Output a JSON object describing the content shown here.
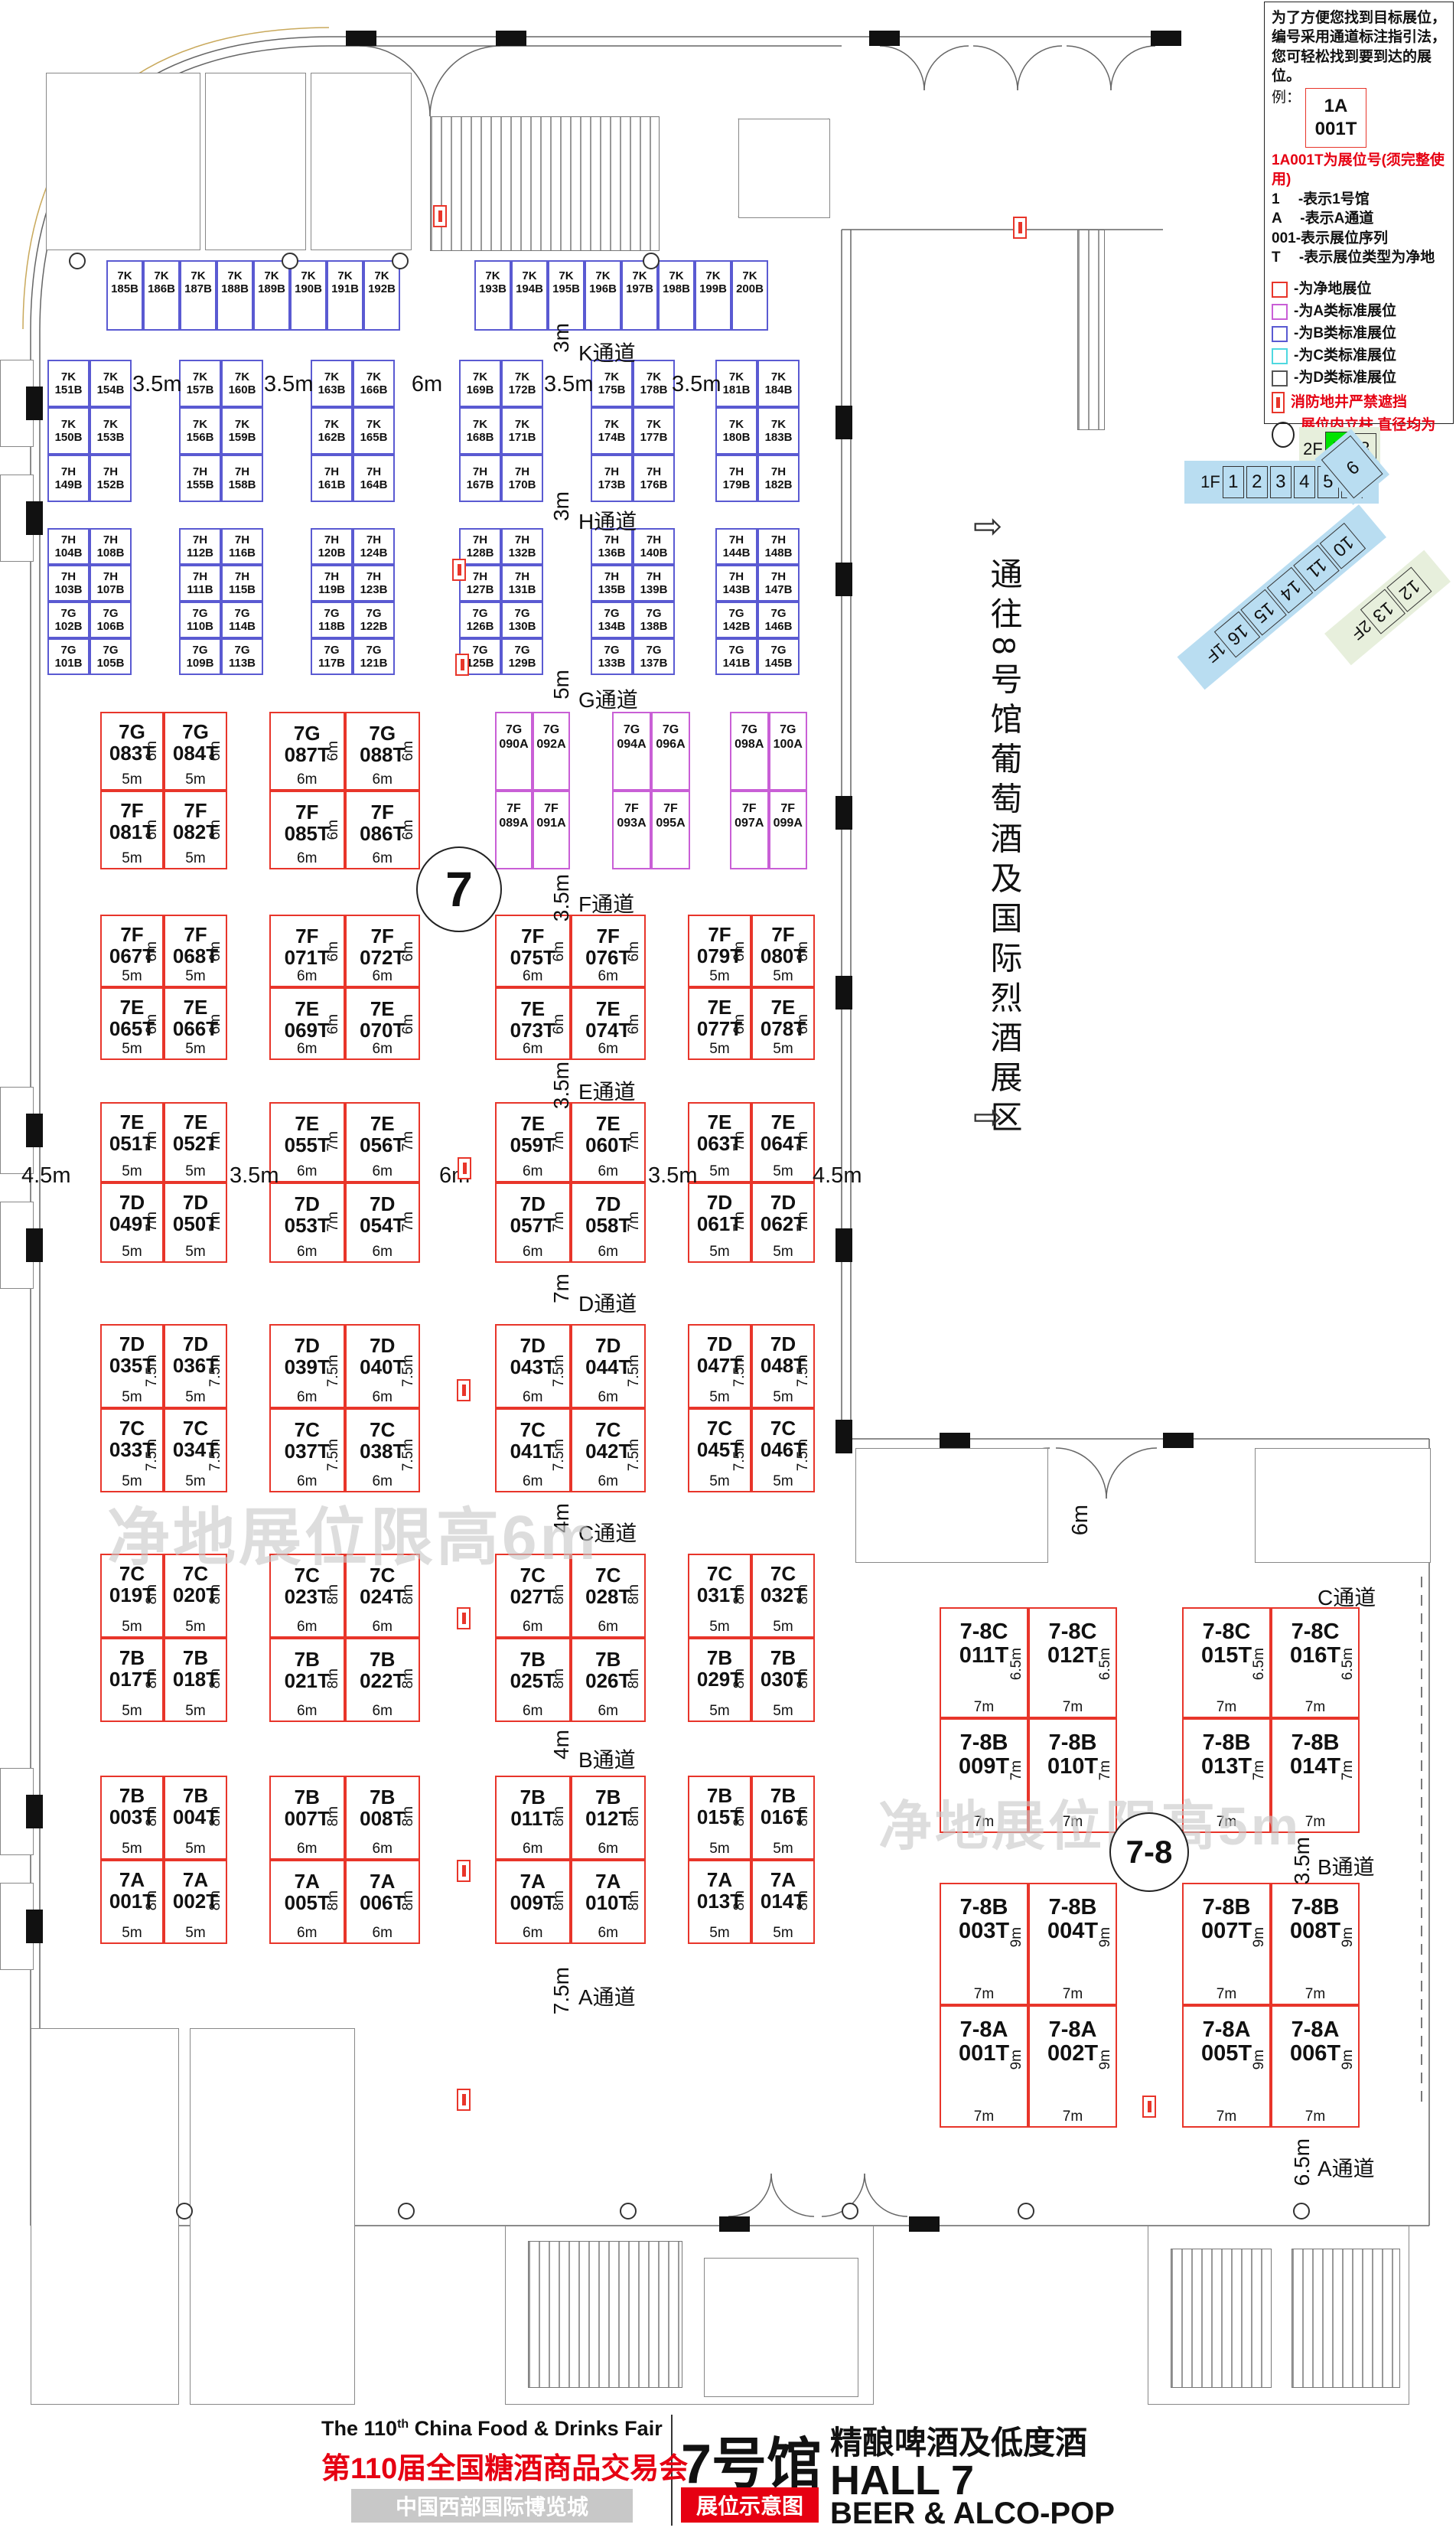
{
  "colors": {
    "net_red": "#e8352a",
    "class_a": "#c95fd6",
    "class_b": "#5a5ad2",
    "class_c": "#4fd8e0",
    "class_d": "#555555",
    "highlight_green": "#00e300",
    "nav_blue": "#b9ddf1",
    "nav_green_bg": "#e7efdc",
    "accent_red": "#e60012",
    "watermark_gray": "#c9c9c9"
  },
  "legend": {
    "intro": "为了方便您找到目标展位，编号采用通道标注指引法，您可轻松找到要到达的展位。",
    "example_label": "例：",
    "example_line1": "1A",
    "example_line2": "001T",
    "example_note": "1A001T为展位号(须完整使用)",
    "explain_lines": [
      "1　 -表示1号馆",
      "A　 -表示A通道",
      "001-表示展位序列",
      "T　 -表示展位类型为净地"
    ],
    "key_items": [
      {
        "name": "net",
        "color": "#e8352a",
        "text": "-为净地展位"
      },
      {
        "name": "class-a",
        "color": "#c95fd6",
        "text": "-为A类标准展位"
      },
      {
        "name": "class-b",
        "color": "#5a5ad2",
        "text": "-为B类标准展位"
      },
      {
        "name": "class-c",
        "color": "#4fd8e0",
        "text": "-为C类标准展位"
      },
      {
        "name": "class-d",
        "color": "#555555",
        "text": "-为D类标准展位"
      }
    ],
    "fire_note": "消防地井严禁遮挡",
    "pillar_note": "展位内立柱 直径均为1.5m"
  },
  "floor_nav": {
    "upper": [
      "2F",
      "7",
      "8"
    ],
    "lower": [
      "1F",
      "1",
      "2",
      "3",
      "4",
      "5",
      "6"
    ],
    "bend": "9",
    "diagonal": [
      "10",
      "11",
      "14",
      "15",
      "16",
      "1F"
    ],
    "green_diagonal": [
      "12",
      "13",
      "2F"
    ]
  },
  "corridor_note": {
    "arrow": "⇨",
    "text": "通往8号馆葡萄酒及国际烈酒展区"
  },
  "watermark_main": "净地展位限高6m",
  "watermark_annex": "净地展位限高5m",
  "hall_circle": "7",
  "annex_circle": "7-8",
  "door_width_note": "6m",
  "aisles_main": [
    {
      "dim": "3m",
      "label": "K通道"
    },
    {
      "dim": "3m",
      "label": "H通道"
    },
    {
      "dim": "5m",
      "label": "G通道"
    },
    {
      "dim": "3.5m",
      "label": "F通道"
    },
    {
      "dim": "3.5m",
      "label": "E通道"
    },
    {
      "dim": "7m",
      "label": "D通道"
    },
    {
      "dim": "4m",
      "label": "C通道"
    },
    {
      "dim": "4m",
      "label": "B通道"
    },
    {
      "dim": "7.5m",
      "label": "A通道"
    }
  ],
  "aisles_annex": [
    {
      "dim": "",
      "label": "C通道"
    },
    {
      "dim": "3.5m",
      "label": "B通道"
    },
    {
      "dim": "6.5m",
      "label": "A通道"
    }
  ],
  "k_gap_labels": [
    "3.5m",
    "3.5m",
    "6m",
    "3.5m",
    "3.5m"
  ],
  "ed_mid_labels": [
    "4.5m",
    "3.5m",
    "6m",
    "3.5m",
    "4.5m"
  ],
  "k_top_row": {
    "group1": [
      "7K 185B",
      "7K 186B",
      "7K 187B",
      "7K 188B",
      "7K 189B",
      "7K 190B",
      "7K 191B",
      "7K 192B"
    ],
    "group2": [
      "7K 193B",
      "7K 194B",
      "7K 195B",
      "7K 196B",
      "7K 197B",
      "7K 198B",
      "7K 199B",
      "7K 200B"
    ]
  },
  "k_blocks": [
    [
      [
        "7K 151B",
        "7K 154B"
      ],
      [
        "7K 150B",
        "7K 153B"
      ],
      [
        "7H 149B",
        "7H 152B"
      ]
    ],
    [
      [
        "7K 157B",
        "7K 160B"
      ],
      [
        "7K 156B",
        "7K 159B"
      ],
      [
        "7H 155B",
        "7H 158B"
      ]
    ],
    [
      [
        "7K 163B",
        "7K 166B"
      ],
      [
        "7K 162B",
        "7K 165B"
      ],
      [
        "7H 161B",
        "7H 164B"
      ]
    ],
    [
      [
        "7K 169B",
        "7K 172B"
      ],
      [
        "7K 168B",
        "7K 171B"
      ],
      [
        "7H 167B",
        "7H 170B"
      ]
    ],
    [
      [
        "7K 175B",
        "7K 178B"
      ],
      [
        "7K 174B",
        "7K 177B"
      ],
      [
        "7H 173B",
        "7H 176B"
      ]
    ],
    [
      [
        "7K 181B",
        "7K 184B"
      ],
      [
        "7K 180B",
        "7K 183B"
      ],
      [
        "7H 179B",
        "7H 182B"
      ]
    ]
  ],
  "h_blocks": [
    [
      [
        "7H 104B",
        "7H 108B"
      ],
      [
        "7H 103B",
        "7H 107B"
      ],
      [
        "7G 102B",
        "7G 106B"
      ],
      [
        "7G 101B",
        "7G 105B"
      ]
    ],
    [
      [
        "7H 112B",
        "7H 116B"
      ],
      [
        "7H 111B",
        "7H 115B"
      ],
      [
        "7G 110B",
        "7G 114B"
      ],
      [
        "7G 109B",
        "7G 113B"
      ]
    ],
    [
      [
        "7H 120B",
        "7H 124B"
      ],
      [
        "7H 119B",
        "7H 123B"
      ],
      [
        "7G 118B",
        "7G 122B"
      ],
      [
        "7G 117B",
        "7G 121B"
      ]
    ],
    [
      [
        "7H 128B",
        "7H 132B"
      ],
      [
        "7H 127B",
        "7H 131B"
      ],
      [
        "7G 126B",
        "7G 130B"
      ],
      [
        "7G 125B",
        "7G 129B"
      ]
    ],
    [
      [
        "7H 136B",
        "7H 140B"
      ],
      [
        "7H 135B",
        "7H 139B"
      ],
      [
        "7G 134B",
        "7G 138B"
      ],
      [
        "7G 133B",
        "7G 137B"
      ]
    ],
    [
      [
        "7H 144B",
        "7H 148B"
      ],
      [
        "7H 143B",
        "7H 147B"
      ],
      [
        "7G 142B",
        "7G 146B"
      ],
      [
        "7G 141B",
        "7G 145B"
      ]
    ]
  ],
  "t_sections": [
    {
      "name": "G-F",
      "blocks": [
        {
          "type": "red",
          "rows": [
            [
              "7G 083T",
              "7G 084T"
            ],
            [
              "7F 081T",
              "7F 082T"
            ]
          ],
          "row_dims": [
            "6m",
            "6m"
          ],
          "col_dims": [
            "5m",
            "5m"
          ]
        },
        {
          "type": "red",
          "rows": [
            [
              "7G 087T",
              "7G 088T"
            ],
            [
              "7F 085T",
              "7F 086T"
            ]
          ],
          "row_dims": [
            "6m",
            "6m"
          ],
          "col_dims": [
            "6m",
            "6m"
          ]
        },
        {
          "type": "purple",
          "rows": [
            [
              "7G 090A",
              "7G 092A"
            ],
            [
              "7F 089A",
              "7F 091A"
            ]
          ]
        },
        {
          "type": "purple",
          "rows": [
            [
              "7G 094A",
              "7G 096A"
            ],
            [
              "7F 093A",
              "7F 095A"
            ]
          ]
        },
        {
          "type": "purple",
          "rows": [
            [
              "7G 098A",
              "7G 100A"
            ],
            [
              "7F 097A",
              "7F 099A"
            ]
          ]
        }
      ]
    },
    {
      "name": "F-E",
      "blocks": [
        {
          "type": "red",
          "rows": [
            [
              "7F 067T",
              "7F 068T"
            ],
            [
              "7E 065T",
              "7E 066T"
            ]
          ],
          "row_dims": [
            "6m",
            "6m"
          ],
          "col_dims": [
            "5m",
            "5m"
          ]
        },
        {
          "type": "red",
          "rows": [
            [
              "7F 071T",
              "7F 072T"
            ],
            [
              "7E 069T",
              "7E 070T"
            ]
          ],
          "row_dims": [
            "6m",
            "6m"
          ],
          "col_dims": [
            "6m",
            "6m"
          ]
        },
        {
          "type": "red",
          "rows": [
            [
              "7F 075T",
              "7F 076T"
            ],
            [
              "7E 073T",
              "7E 074T"
            ]
          ],
          "row_dims": [
            "6m",
            "6m"
          ],
          "col_dims": [
            "6m",
            "6m"
          ]
        },
        {
          "type": "red",
          "rows": [
            [
              "7F 079T",
              "7F 080T"
            ],
            [
              "7E 077T",
              "7E 078T"
            ]
          ],
          "row_dims": [
            "6m",
            "6m"
          ],
          "col_dims": [
            "5m",
            "5m"
          ]
        }
      ]
    },
    {
      "name": "E-D",
      "blocks": [
        {
          "type": "red",
          "rows": [
            [
              "7E 051T",
              "7E 052T"
            ],
            [
              "7D 049T",
              "7D 050T"
            ]
          ],
          "row_dims": [
            "7m",
            "7m"
          ],
          "col_dims": [
            "5m",
            "5m"
          ]
        },
        {
          "type": "red",
          "rows": [
            [
              "7E 055T",
              "7E 056T"
            ],
            [
              "7D 053T",
              "7D 054T"
            ]
          ],
          "row_dims": [
            "7m",
            "7m"
          ],
          "col_dims": [
            "6m",
            "6m"
          ]
        },
        {
          "type": "red",
          "rows": [
            [
              "7E 059T",
              "7E 060T"
            ],
            [
              "7D 057T",
              "7D 058T"
            ]
          ],
          "row_dims": [
            "7m",
            "7m"
          ],
          "col_dims": [
            "6m",
            "6m"
          ]
        },
        {
          "type": "red",
          "rows": [
            [
              "7E 063T",
              "7E 064T"
            ],
            [
              "7D 061T",
              "7D 062T"
            ]
          ],
          "row_dims": [
            "7m",
            "7m"
          ],
          "col_dims": [
            "5m",
            "5m"
          ]
        }
      ]
    },
    {
      "name": "D-C",
      "blocks": [
        {
          "type": "red",
          "rows": [
            [
              "7D 035T",
              "7D 036T"
            ],
            [
              "7C 033T",
              "7C 034T"
            ]
          ],
          "row_dims": [
            "7.5m",
            "7.5m"
          ],
          "col_dims": [
            "5m",
            "5m"
          ]
        },
        {
          "type": "red",
          "rows": [
            [
              "7D 039T",
              "7D 040T"
            ],
            [
              "7C 037T",
              "7C 038T"
            ]
          ],
          "row_dims": [
            "7.5m",
            "7.5m"
          ],
          "col_dims": [
            "6m",
            "6m"
          ]
        },
        {
          "type": "red",
          "rows": [
            [
              "7D 043T",
              "7D 044T"
            ],
            [
              "7C 041T",
              "7C 042T"
            ]
          ],
          "row_dims": [
            "7.5m",
            "7.5m"
          ],
          "col_dims": [
            "6m",
            "6m"
          ]
        },
        {
          "type": "red",
          "rows": [
            [
              "7D 047T",
              "7D 048T"
            ],
            [
              "7C 045T",
              "7C 046T"
            ]
          ],
          "row_dims": [
            "7.5m",
            "7.5m"
          ],
          "col_dims": [
            "5m",
            "5m"
          ]
        }
      ]
    },
    {
      "name": "C-B",
      "blocks": [
        {
          "type": "red",
          "rows": [
            [
              "7C 019T",
              "7C 020T"
            ],
            [
              "7B 017T",
              "7B 018T"
            ]
          ],
          "row_dims": [
            "8m",
            "8m"
          ],
          "col_dims": [
            "5m",
            "5m"
          ]
        },
        {
          "type": "red",
          "rows": [
            [
              "7C 023T",
              "7C 024T"
            ],
            [
              "7B 021T",
              "7B 022T"
            ]
          ],
          "row_dims": [
            "8m",
            "8m"
          ],
          "col_dims": [
            "6m",
            "6m"
          ]
        },
        {
          "type": "red",
          "rows": [
            [
              "7C 027T",
              "7C 028T"
            ],
            [
              "7B 025T",
              "7B 026T"
            ]
          ],
          "row_dims": [
            "8m",
            "8m"
          ],
          "col_dims": [
            "6m",
            "6m"
          ]
        },
        {
          "type": "red",
          "rows": [
            [
              "7C 031T",
              "7C 032T"
            ],
            [
              "7B 029T",
              "7B 030T"
            ]
          ],
          "row_dims": [
            "8m",
            "8m"
          ],
          "col_dims": [
            "5m",
            "5m"
          ]
        }
      ]
    },
    {
      "name": "B-A",
      "blocks": [
        {
          "type": "red",
          "rows": [
            [
              "7B 003T",
              "7B 004T"
            ],
            [
              "7A 001T",
              "7A 002T"
            ]
          ],
          "row_dims": [
            "8m",
            "8m"
          ],
          "col_dims": [
            "5m",
            "5m"
          ]
        },
        {
          "type": "red",
          "rows": [
            [
              "7B 007T",
              "7B 008T"
            ],
            [
              "7A 005T",
              "7A 006T"
            ]
          ],
          "row_dims": [
            "8m",
            "8m"
          ],
          "col_dims": [
            "6m",
            "6m"
          ]
        },
        {
          "type": "red",
          "rows": [
            [
              "7B 011T",
              "7B 012T"
            ],
            [
              "7A 009T",
              "7A 010T"
            ]
          ],
          "row_dims": [
            "8m",
            "8m"
          ],
          "col_dims": [
            "6m",
            "6m"
          ]
        },
        {
          "type": "red",
          "rows": [
            [
              "7B 015T",
              "7B 016T"
            ],
            [
              "7A 013T",
              "7A 014T"
            ]
          ],
          "row_dims": [
            "8m",
            "8m"
          ],
          "col_dims": [
            "5m",
            "5m"
          ]
        }
      ]
    }
  ],
  "annex_sections": [
    {
      "blocks": [
        {
          "rows": [
            [
              "7-8C 011T",
              "7-8C 012T"
            ],
            [
              "7-8B 009T",
              "7-8B 010T"
            ]
          ],
          "row_dims": [
            "6.5m",
            "7m"
          ],
          "col_dims": [
            "7m",
            "7m"
          ]
        },
        {
          "rows": [
            [
              "7-8C 015T",
              "7-8C 016T"
            ],
            [
              "7-8B 013T",
              "7-8B 014T"
            ]
          ],
          "row_dims": [
            "6.5m",
            "7m"
          ],
          "col_dims": [
            "7m",
            "7m"
          ]
        }
      ]
    },
    {
      "blocks": [
        {
          "rows": [
            [
              "7-8B 003T",
              "7-8B 004T"
            ],
            [
              "7-8A 001T",
              "7-8A 002T"
            ]
          ],
          "row_dims": [
            "9m",
            "9m"
          ],
          "col_dims": [
            "7m",
            "7m"
          ]
        },
        {
          "rows": [
            [
              "7-8B 007T",
              "7-8B 008T"
            ],
            [
              "7-8A 005T",
              "7-8A 006T"
            ]
          ],
          "row_dims": [
            "9m",
            "9m"
          ],
          "col_dims": [
            "7m",
            "7m"
          ]
        }
      ]
    }
  ],
  "title_block": {
    "en_pre": "The 110",
    "en_sup": "th",
    "en_post": " China Food & Drinks Fair",
    "cn": "第110届全国糖酒商品交易会",
    "venue": "中国西部国际博览城",
    "hall_cn": "7号馆",
    "tag": "展位示意图",
    "sub_cn": "精酿啤酒及低度酒",
    "hall_en": "HALL 7",
    "sub_en": "BEER & ALCO-POP"
  }
}
